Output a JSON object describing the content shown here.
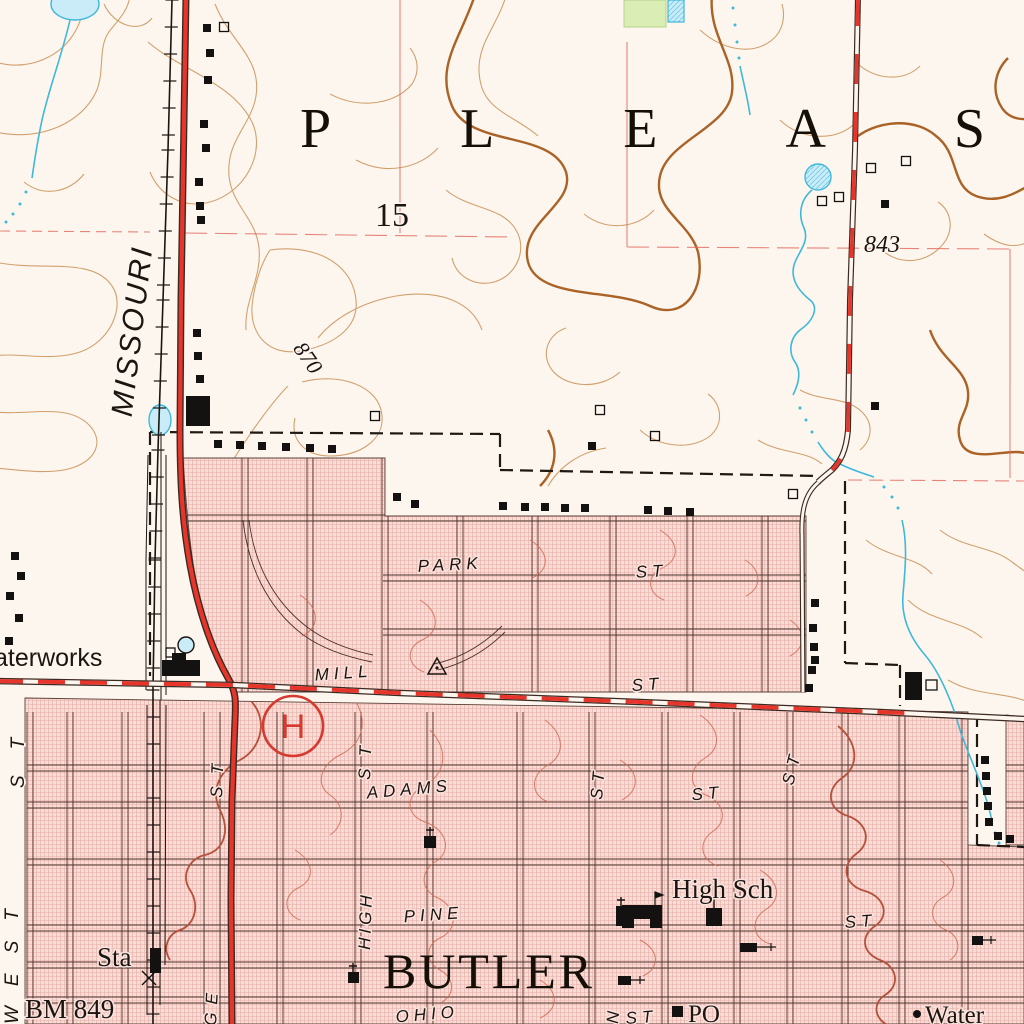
{
  "map": {
    "township_label": "P L E A S",
    "section_number": "15",
    "city_name": "BUTLER",
    "railroad_label": "MISSOURI",
    "elevations": {
      "spot_843": "843",
      "contour_870": "870",
      "benchmark": "BM 849"
    },
    "features": {
      "waterworks": "aterworks",
      "station": "Sta",
      "high_school": "High Sch",
      "post_office": "PO",
      "water_tower": "Water",
      "hospital": "H"
    },
    "streets": {
      "park": "PARK",
      "park_st": "ST",
      "mill": "MILL",
      "mill_st": "ST",
      "adams": "ADAMS",
      "adams_st": "ST",
      "pine": "PINE",
      "pine_st": "ST",
      "ohio": "OHIO",
      "ohio_st": "ST",
      "high": "HIGH",
      "high_st": "ST",
      "hwy_st": "ST",
      "orange_partial": "GE",
      "west": "WEST",
      "west_st": "ST",
      "main_partial": "N",
      "st_mid": "ST",
      "st_east": "ST"
    },
    "colors": {
      "paper": "#fcf6ee",
      "urban_tint": "#f8dcd6",
      "urban_hatch": "#c83e30",
      "contour": "#d2a06e",
      "contour_index": "#aa6226",
      "water": "#3fb8dc",
      "vegetation": "#d9edb4",
      "highway_red": "#e8352b",
      "section_line_red": "#e2685c",
      "hospital_red": "#d63a2f",
      "ink_black": "#1c1410"
    }
  }
}
